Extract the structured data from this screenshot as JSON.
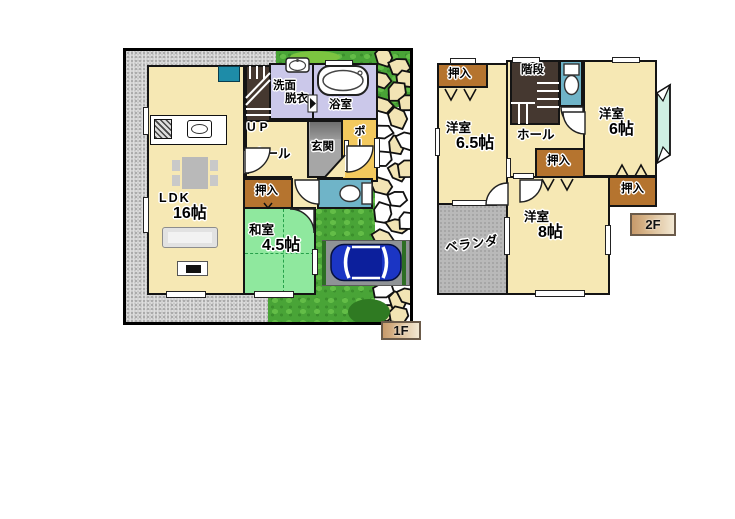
{
  "floors": {
    "f1": {
      "tag": "1F",
      "ldk_line1": "LDK",
      "ldk_line2": "16帖",
      "washitsu_line1": "和室",
      "washitsu_line2": "4.5帖",
      "senmen_line1": "洗面",
      "senmen_line2": "脱衣",
      "bath": "浴室",
      "up": "UP",
      "hall": "ホール",
      "genkan": "玄関",
      "porch": "ポーチ",
      "oshiire": "押入"
    },
    "f2": {
      "tag": "2F",
      "room65_line1": "洋室",
      "room65_line2": "6.5帖",
      "room6_line1": "洋室",
      "room6_line2": "6帖",
      "room8_line1": "洋室",
      "room8_line2": "8帖",
      "stairs": "階段",
      "hall": "ホール",
      "oshiire_tl": "押入",
      "oshiire_mid": "押入",
      "oshiire_right": "押入",
      "veranda": "ベランダ"
    }
  },
  "colors": {
    "cream": "#F6E8B4",
    "tatami": "#8FE89E",
    "closet": "#B5742F",
    "bathp": "#CBC8EA",
    "toilet": "#6FB4C8",
    "porch": "#F3C95E",
    "grass": "#49A437",
    "veranda": "#B9B9B9",
    "stair": "#453830",
    "car_blue": "#1B35C4",
    "genkan": "#A6A6A6",
    "stone_beige": "#F2E4B4",
    "tagtan": "#C79A6B",
    "cabinet_teal": "#1E8CA8"
  }
}
